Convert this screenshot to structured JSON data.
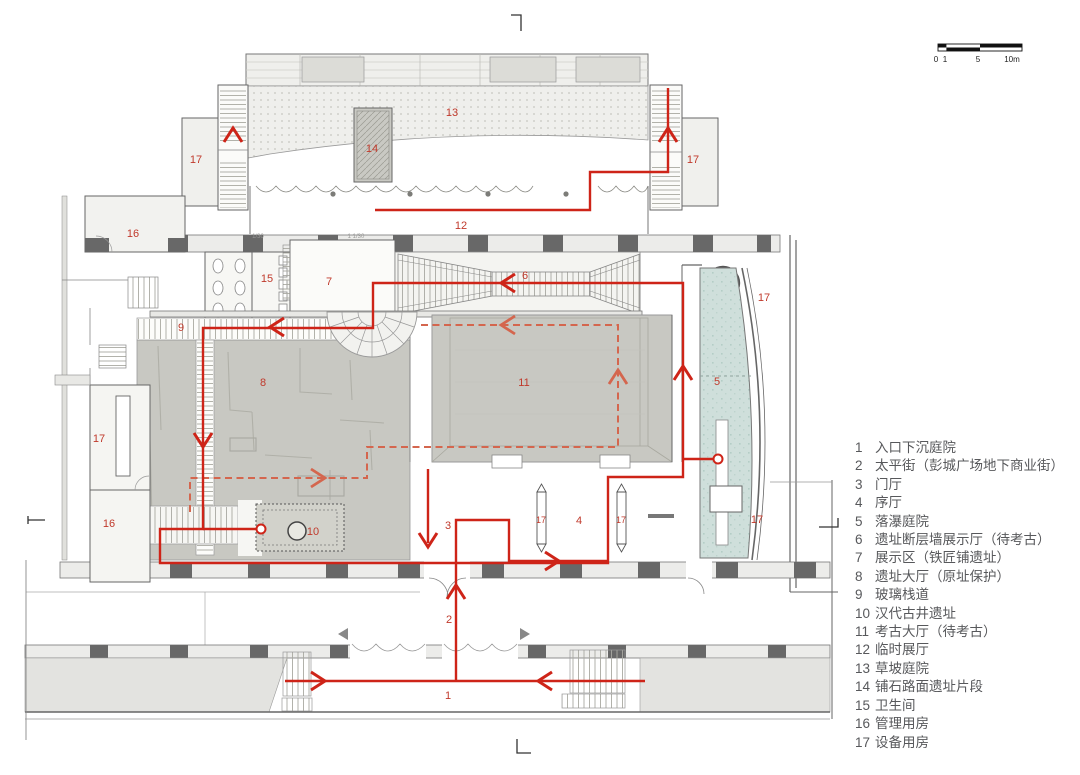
{
  "title": "museum-level-plan",
  "legend": {
    "items": [
      {
        "num": "1",
        "label": "入口下沉庭院"
      },
      {
        "num": "2",
        "label": "太平街（彭城广场地下商业街）"
      },
      {
        "num": "3",
        "label": "门厅"
      },
      {
        "num": "4",
        "label": "序厅"
      },
      {
        "num": "5",
        "label": "落瀑庭院"
      },
      {
        "num": "6",
        "label": "遗址断层墙展示厅（待考古）"
      },
      {
        "num": "7",
        "label": "展示区（铁匠铺遗址）"
      },
      {
        "num": "8",
        "label": "遗址大厅（原址保护）"
      },
      {
        "num": "9",
        "label": "玻璃栈道"
      },
      {
        "num": "10",
        "label": "汉代古井遗址"
      },
      {
        "num": "11",
        "label": "考古大厅（待考古）"
      },
      {
        "num": "12",
        "label": "临时展厅"
      },
      {
        "num": "13",
        "label": "草坡庭院"
      },
      {
        "num": "14",
        "label": "铺石路面遗址片段"
      },
      {
        "num": "15",
        "label": "卫生间"
      },
      {
        "num": "16",
        "label": "管理用房"
      },
      {
        "num": "17",
        "label": "设备用房"
      }
    ]
  },
  "scale_bar": {
    "labels": [
      {
        "t": "0",
        "x": 936
      },
      {
        "t": "1",
        "x": 945
      },
      {
        "t": "5",
        "x": 978
      },
      {
        "t": "10m",
        "x": 1012
      }
    ]
  },
  "plan": {
    "room_labels": [
      {
        "t": "1",
        "x": 448,
        "y": 699
      },
      {
        "t": "2",
        "x": 449,
        "y": 623
      },
      {
        "t": "3",
        "x": 448,
        "y": 529
      },
      {
        "t": "4",
        "x": 579,
        "y": 524
      },
      {
        "t": "5",
        "x": 717,
        "y": 385
      },
      {
        "t": "6",
        "x": 525,
        "y": 279
      },
      {
        "t": "7",
        "x": 329,
        "y": 285
      },
      {
        "t": "8",
        "x": 263,
        "y": 386
      },
      {
        "t": "9",
        "x": 181,
        "y": 331
      },
      {
        "t": "10",
        "x": 313,
        "y": 535
      },
      {
        "t": "11",
        "x": 524,
        "y": 386
      },
      {
        "t": "12",
        "x": 461,
        "y": 229
      },
      {
        "t": "13",
        "x": 452,
        "y": 116
      },
      {
        "t": "14",
        "x": 372,
        "y": 152
      },
      {
        "t": "15",
        "x": 267,
        "y": 282
      },
      {
        "t": "16",
        "x": 133,
        "y": 237
      },
      {
        "t": "16",
        "x": 109,
        "y": 527
      },
      {
        "t": "17",
        "x": 196,
        "y": 163
      },
      {
        "t": "17",
        "x": 693,
        "y": 163
      },
      {
        "t": "17",
        "x": 764,
        "y": 301
      },
      {
        "t": "17",
        "x": 99,
        "y": 442
      },
      {
        "t": "17",
        "x": 757,
        "y": 523
      }
    ],
    "shaft_labels": [
      {
        "t": "17",
        "x": 541,
        "y": 523
      },
      {
        "t": "17",
        "x": 621,
        "y": 523
      }
    ],
    "annotations": [
      {
        "t": "1/30",
        "x": 258,
        "y": 238
      },
      {
        "t": "1 1/30",
        "x": 356,
        "y": 238
      }
    ],
    "colors": {
      "route_red": "#ce2418",
      "route_dashed": "#d4664e",
      "label_red": "#c0392b",
      "hall_gray": "#c8c8c2",
      "court_teal": "#cfdfdb",
      "wall_dark": "#686868",
      "wall_light": "#ececea",
      "legend_text": "#57585b"
    }
  }
}
